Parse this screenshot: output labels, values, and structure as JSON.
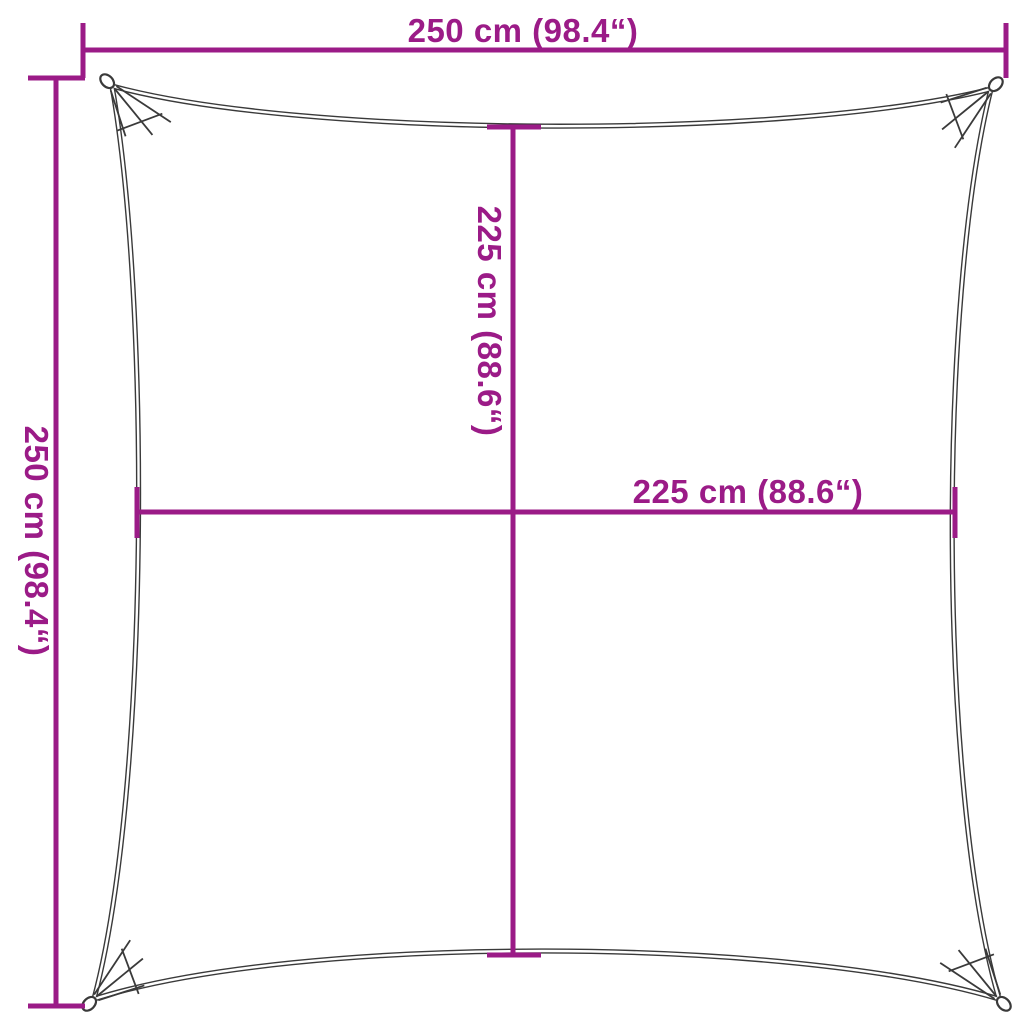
{
  "diagram": {
    "type": "product-dimension-diagram",
    "subject": "square shade sail with reinforced corners and grommets",
    "background": "#ffffff",
    "colors": {
      "dimension_color": "#9B1B87",
      "outline_color": "#3A3A3A"
    },
    "dimensions": {
      "top_width": {
        "label": "250 cm (98.4“)",
        "cm": 250,
        "inches": 98.4
      },
      "left_height": {
        "label": "250 cm (98.4“)",
        "cm": 250,
        "inches": 98.4
      },
      "inner_height": {
        "label": "225 cm (88.6“)",
        "cm": 225,
        "inches": 88.6
      },
      "inner_width": {
        "label": "225 cm (88.6“)",
        "cm": 225,
        "inches": 88.6
      }
    }
  }
}
